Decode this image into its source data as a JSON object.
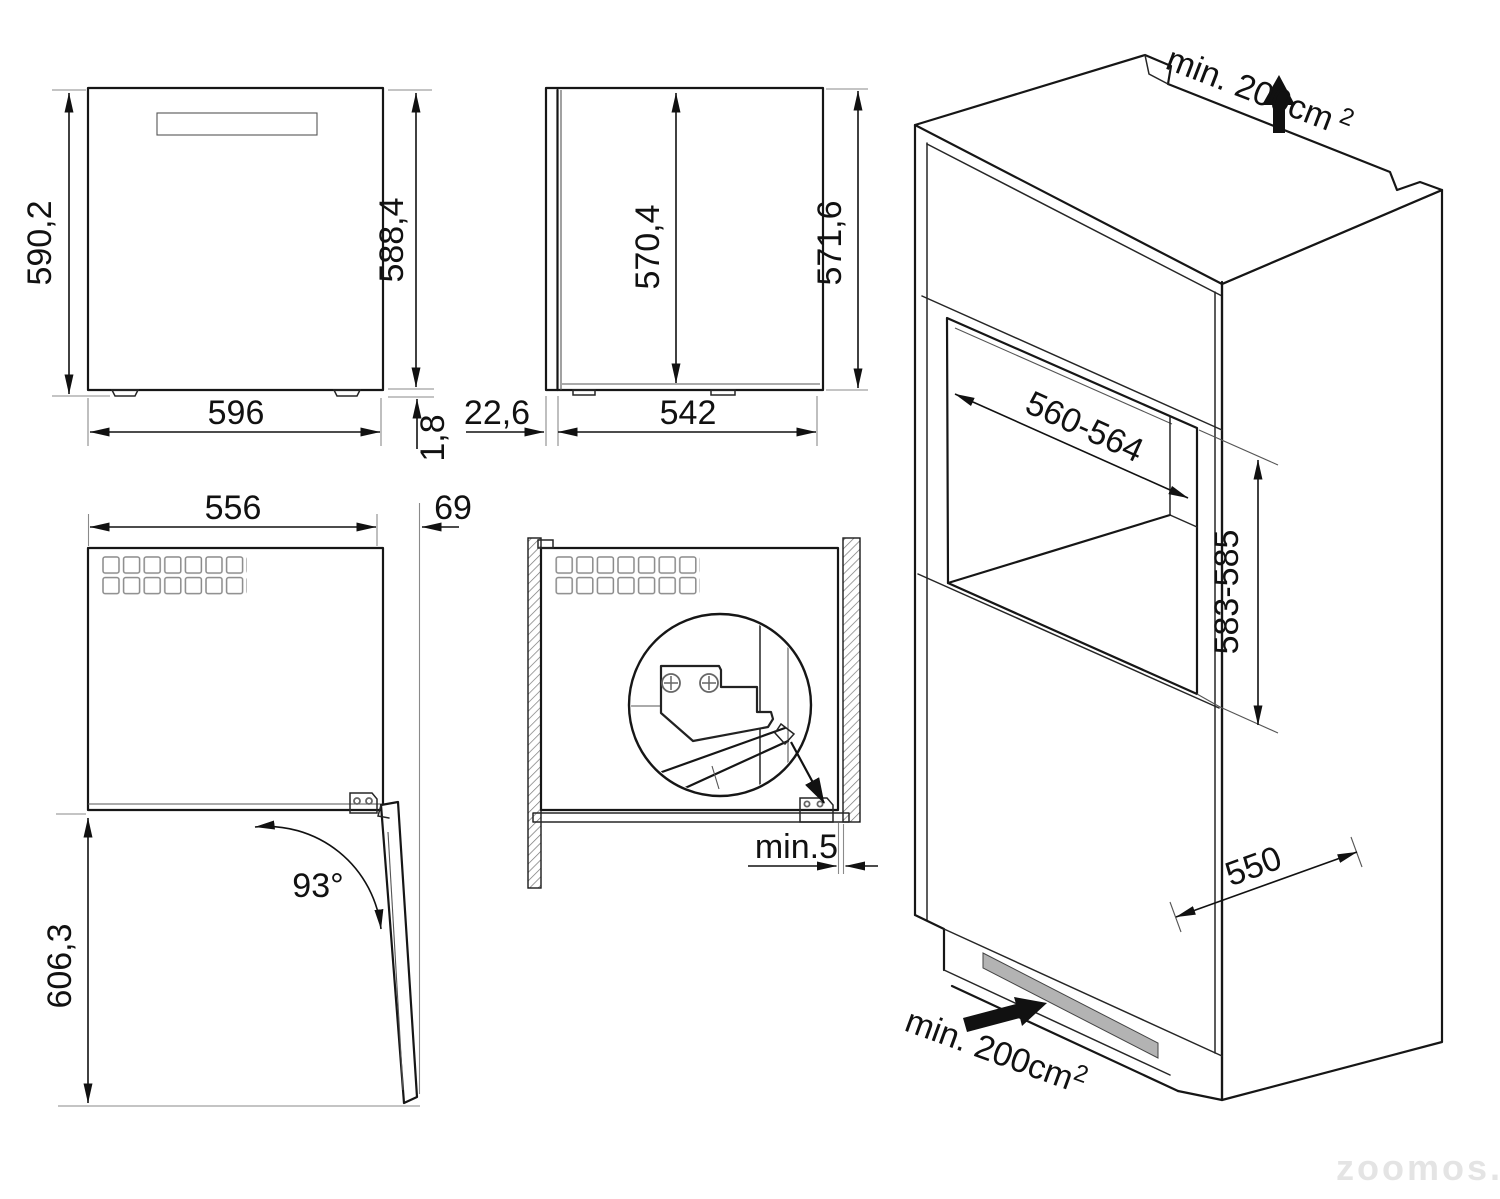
{
  "diagram_title": "built-in appliance installation dimensions",
  "units": "mm",
  "colors": {
    "line": "#161616",
    "extension_line": "#8a8a8a",
    "vent_slot_fill": "#b3b3b3",
    "watermark": "#e4e4e4"
  },
  "views": {
    "front": {
      "height_left": "590,2",
      "height_right": "588,4",
      "width": "596",
      "foot_height": "1,8"
    },
    "side": {
      "door_thickness": "22,6",
      "body_depth": "542",
      "inner_height": "570,4",
      "total_height": "571,6"
    },
    "top_open_door": {
      "body_width": "556",
      "door_projection": "69",
      "door_angle": "93°",
      "depth_door_open": "606,3"
    },
    "top_installed": {
      "side_clearance": "min.5"
    },
    "isometric_niche": {
      "vent_top": "min. 200cm",
      "vent_top_sup": "2",
      "niche_width": "560-564",
      "niche_height": "583-585",
      "niche_depth": "550",
      "vent_bottom": "min. 200cm",
      "vent_bottom_sup": "2"
    }
  },
  "watermark": "zoomos.by"
}
